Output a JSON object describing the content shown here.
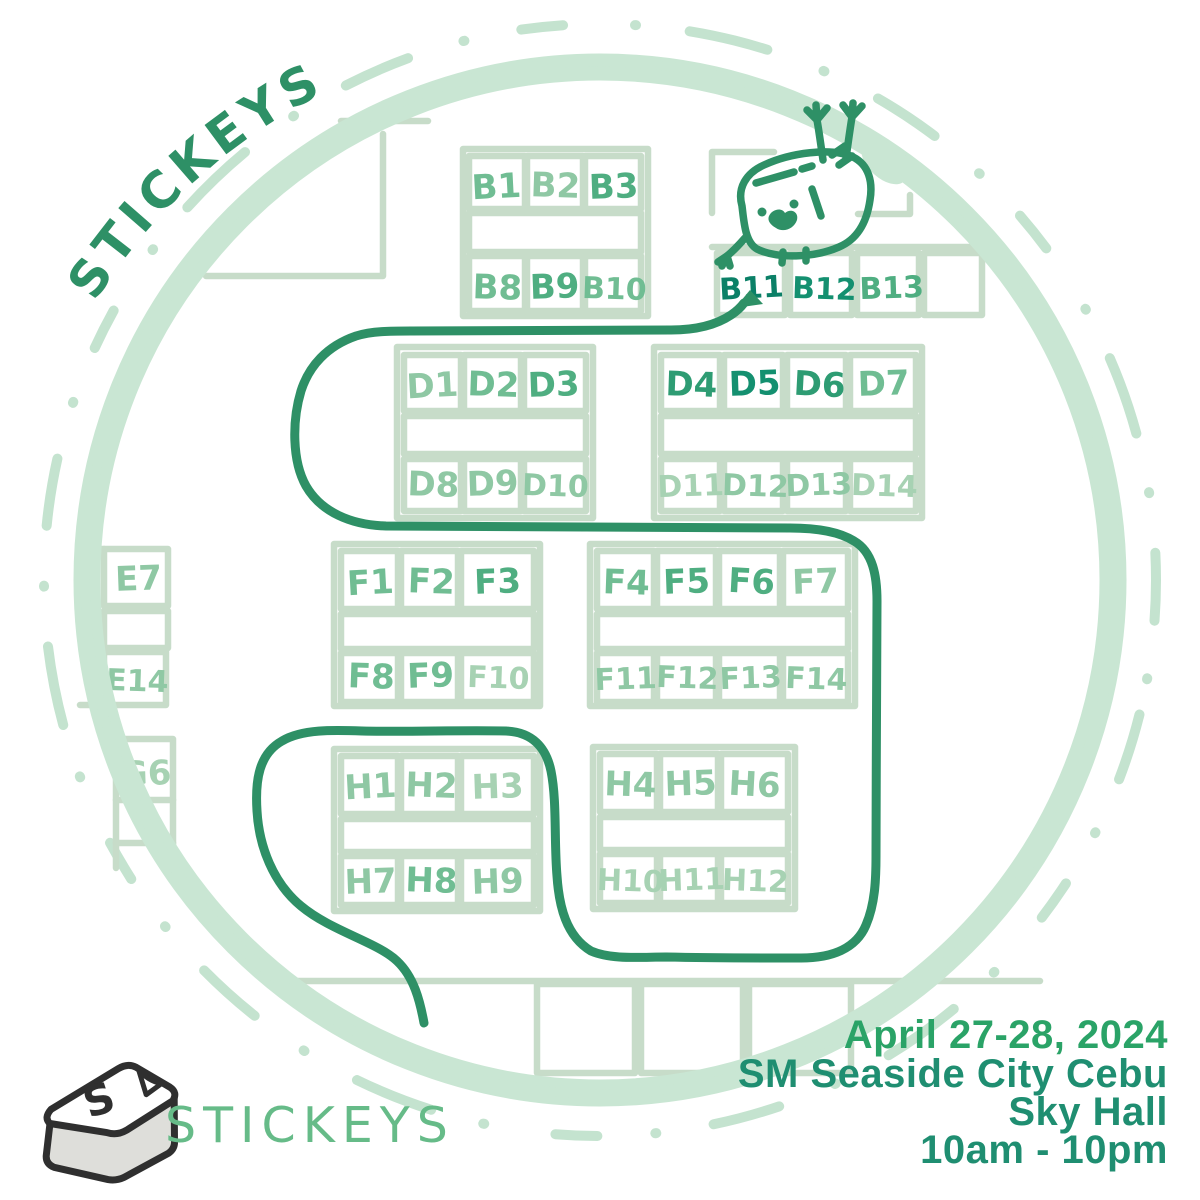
{
  "branding": {
    "arc_title": "STICKEYS",
    "logo_text": "STICKEYS",
    "logo_letter": "S"
  },
  "event": {
    "date": "April 27-28, 2024",
    "venue": "SM Seaside City Cebu",
    "hall": "Sky Hall",
    "hours": "10am - 10pm"
  },
  "colors": {
    "accent_dark": "#2e9066",
    "brush_ring": "#c9e6d3",
    "dashed_ring": "#c4e3cf",
    "wall_outline": "#c7dcc9",
    "info_date": "#2aa367",
    "info_detail": "#1f8e71",
    "logo_green": "#66bb88",
    "keycap_outline": "#2f2f2f",
    "keycap_side": "#dededa",
    "keycap_top": "#ffffff",
    "peel_mint": "#b9e0c8",
    "tones": {
      "t1": "#a7d2b3",
      "t2": "#8fc8a4",
      "t3": "#70bd93",
      "t4": "#4fae81",
      "t5": "#2e9c73",
      "t6": "#149070",
      "t7": "#0b8067"
    }
  },
  "map": {
    "highlighted_booth": "B11",
    "mascot": "keycap-character",
    "booths": [
      {
        "label": "B1",
        "x": 497,
        "y": 198,
        "tone": "t3",
        "size": 34,
        "rot": -3
      },
      {
        "label": "B2",
        "x": 555,
        "y": 197,
        "tone": "t2",
        "size": 34,
        "rot": 2
      },
      {
        "label": "B3",
        "x": 614,
        "y": 198,
        "tone": "t4",
        "size": 34,
        "rot": -2
      },
      {
        "label": "B8",
        "x": 497,
        "y": 299,
        "tone": "t3",
        "size": 34,
        "rot": 2
      },
      {
        "label": "B9",
        "x": 555,
        "y": 298,
        "tone": "t4",
        "size": 34,
        "rot": -2
      },
      {
        "label": "B10",
        "x": 614,
        "y": 299,
        "tone": "t3",
        "size": 30,
        "rot": 2
      },
      {
        "label": "B11",
        "x": 752,
        "y": 298,
        "tone": "t7",
        "size": 30,
        "rot": -3
      },
      {
        "label": "B12",
        "x": 824,
        "y": 299,
        "tone": "t6",
        "size": 30,
        "rot": 2
      },
      {
        "label": "B13",
        "x": 892,
        "y": 298,
        "tone": "t4",
        "size": 30,
        "rot": -2
      },
      {
        "label": "D1",
        "x": 433,
        "y": 397,
        "tone": "t2",
        "size": 34,
        "rot": -3
      },
      {
        "label": "D2",
        "x": 493,
        "y": 396,
        "tone": "t3",
        "size": 34,
        "rot": 2
      },
      {
        "label": "D3",
        "x": 554,
        "y": 396,
        "tone": "t4",
        "size": 34,
        "rot": -2
      },
      {
        "label": "D4",
        "x": 691,
        "y": 396,
        "tone": "t5",
        "size": 34,
        "rot": 2
      },
      {
        "label": "D5",
        "x": 755,
        "y": 395,
        "tone": "t6",
        "size": 34,
        "rot": -2
      },
      {
        "label": "D6",
        "x": 819,
        "y": 396,
        "tone": "t5",
        "size": 34,
        "rot": 3
      },
      {
        "label": "D7",
        "x": 884,
        "y": 395,
        "tone": "t3",
        "size": 34,
        "rot": -2
      },
      {
        "label": "D8",
        "x": 433,
        "y": 496,
        "tone": "t2",
        "size": 34,
        "rot": 2
      },
      {
        "label": "D9",
        "x": 493,
        "y": 495,
        "tone": "t2",
        "size": 34,
        "rot": -2
      },
      {
        "label": "D10",
        "x": 555,
        "y": 496,
        "tone": "t2",
        "size": 30,
        "rot": 2
      },
      {
        "label": "D11",
        "x": 691,
        "y": 496,
        "tone": "t1",
        "size": 30,
        "rot": -2
      },
      {
        "label": "D12",
        "x": 755,
        "y": 496,
        "tone": "t2",
        "size": 30,
        "rot": 2
      },
      {
        "label": "D13",
        "x": 819,
        "y": 495,
        "tone": "t2",
        "size": 30,
        "rot": -2
      },
      {
        "label": "D14",
        "x": 884,
        "y": 496,
        "tone": "t1",
        "size": 30,
        "rot": 2
      },
      {
        "label": "E7",
        "x": 139,
        "y": 590,
        "tone": "t2",
        "size": 34,
        "rot": -2
      },
      {
        "label": "E14",
        "x": 137,
        "y": 691,
        "tone": "t2",
        "size": 30,
        "rot": 2
      },
      {
        "label": "F1",
        "x": 371,
        "y": 594,
        "tone": "t3",
        "size": 34,
        "rot": -3
      },
      {
        "label": "F2",
        "x": 431,
        "y": 593,
        "tone": "t3",
        "size": 34,
        "rot": 2
      },
      {
        "label": "F3",
        "x": 498,
        "y": 593,
        "tone": "t4",
        "size": 34,
        "rot": -2
      },
      {
        "label": "F4",
        "x": 626,
        "y": 594,
        "tone": "t3",
        "size": 34,
        "rot": 2
      },
      {
        "label": "F5",
        "x": 687,
        "y": 593,
        "tone": "t4",
        "size": 34,
        "rot": -2
      },
      {
        "label": "F6",
        "x": 751,
        "y": 593,
        "tone": "t4",
        "size": 34,
        "rot": 3
      },
      {
        "label": "F7",
        "x": 816,
        "y": 593,
        "tone": "t2",
        "size": 34,
        "rot": -2
      },
      {
        "label": "F8",
        "x": 371,
        "y": 688,
        "tone": "t3",
        "size": 34,
        "rot": 2
      },
      {
        "label": "F9",
        "x": 431,
        "y": 687,
        "tone": "t3",
        "size": 34,
        "rot": -2
      },
      {
        "label": "F10",
        "x": 498,
        "y": 688,
        "tone": "t1",
        "size": 30,
        "rot": 2
      },
      {
        "label": "F11",
        "x": 626,
        "y": 689,
        "tone": "t2",
        "size": 30,
        "rot": -2
      },
      {
        "label": "F12",
        "x": 687,
        "y": 688,
        "tone": "t2",
        "size": 30,
        "rot": 2
      },
      {
        "label": "F13",
        "x": 751,
        "y": 688,
        "tone": "t2",
        "size": 30,
        "rot": -2
      },
      {
        "label": "F14",
        "x": 816,
        "y": 689,
        "tone": "t2",
        "size": 30,
        "rot": 2
      },
      {
        "label": "G6",
        "x": 146,
        "y": 785,
        "tone": "t1",
        "size": 34,
        "rot": -2
      },
      {
        "label": "H1",
        "x": 371,
        "y": 798,
        "tone": "t2",
        "size": 34,
        "rot": -3
      },
      {
        "label": "H2",
        "x": 431,
        "y": 797,
        "tone": "t2",
        "size": 34,
        "rot": 2
      },
      {
        "label": "H3",
        "x": 498,
        "y": 798,
        "tone": "t1",
        "size": 34,
        "rot": -2
      },
      {
        "label": "H4",
        "x": 630,
        "y": 796,
        "tone": "t2",
        "size": 34,
        "rot": 2
      },
      {
        "label": "H5",
        "x": 691,
        "y": 795,
        "tone": "t2",
        "size": 34,
        "rot": -2
      },
      {
        "label": "H6",
        "x": 754,
        "y": 796,
        "tone": "t2",
        "size": 34,
        "rot": 3
      },
      {
        "label": "H7",
        "x": 371,
        "y": 893,
        "tone": "t2",
        "size": 34,
        "rot": -2
      },
      {
        "label": "H8",
        "x": 431,
        "y": 892,
        "tone": "t3",
        "size": 34,
        "rot": 2
      },
      {
        "label": "H9",
        "x": 498,
        "y": 893,
        "tone": "t2",
        "size": 34,
        "rot": -2
      },
      {
        "label": "H10",
        "x": 630,
        "y": 891,
        "tone": "t1",
        "size": 30,
        "rot": 2
      },
      {
        "label": "H11",
        "x": 692,
        "y": 890,
        "tone": "t1",
        "size": 30,
        "rot": -2
      },
      {
        "label": "H12",
        "x": 755,
        "y": 891,
        "tone": "t1",
        "size": 30,
        "rot": 2
      }
    ]
  }
}
